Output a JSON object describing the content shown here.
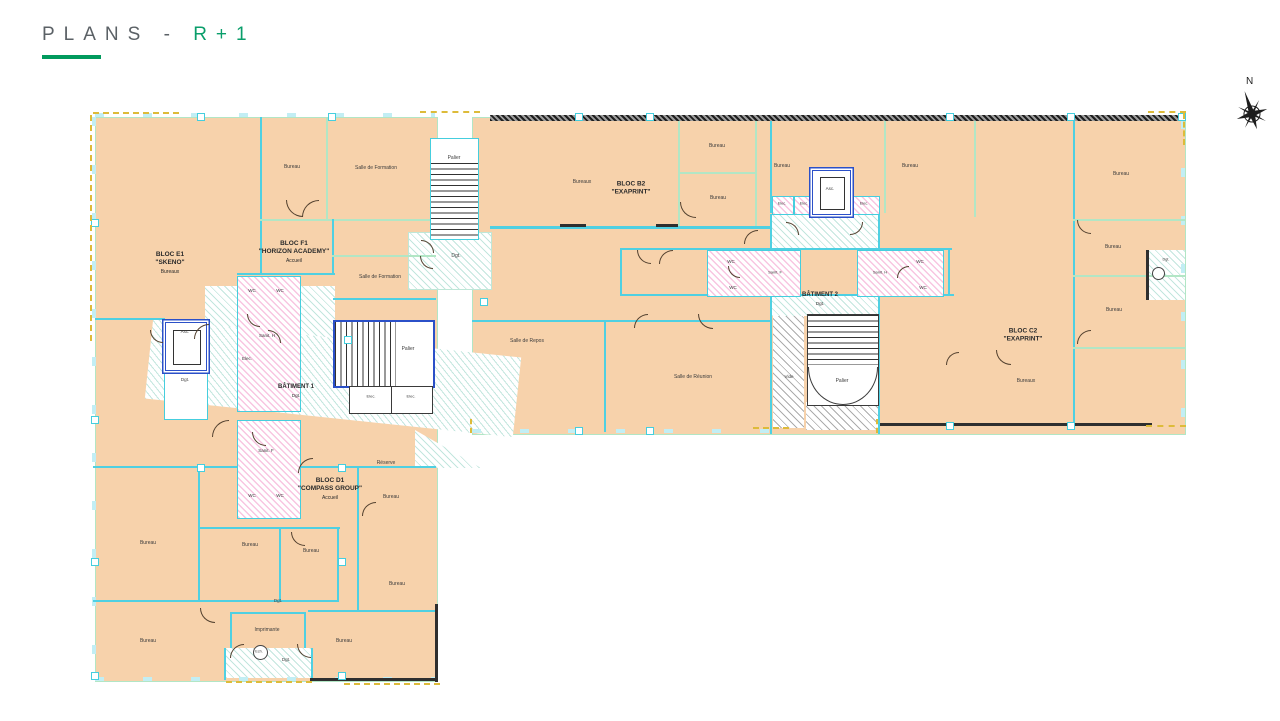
{
  "title": {
    "prefix": "PLANS -",
    "floor": "R+1"
  },
  "compass": {
    "north": "N"
  },
  "colors": {
    "accent_green": "#019a5d",
    "floor_text_green": "#0a9e6b",
    "room_fill": "#f7d2ab",
    "wall_cyan": "#4fd0e2",
    "wall_green": "#b2e6c5",
    "detail_blue": "#2b50c8",
    "sanitary_pink": "#f296c8",
    "accent_yellow": "#ddbb3a"
  },
  "blocks": {
    "e1": {
      "line1": "BLOC E1",
      "line2": "\"SKENO\"",
      "line3": "Bureaux"
    },
    "f1": {
      "line1": "BLOC F1",
      "line2": "\"HORIZON ACADEMY\"",
      "line3": "Accueil"
    },
    "b2": {
      "line1": "BLOC B2",
      "line2": "\"EXAPRINT\""
    },
    "c2": {
      "line1": "BLOC C2",
      "line2": "\"EXAPRINT\"",
      "line3": "Bureaux"
    },
    "d1": {
      "line1": "BLOC D1",
      "line2": "\"COMPASS GROUP\"",
      "line3": "Accueil"
    }
  },
  "buildings": {
    "b1": "BÂTIMENT 1",
    "b2": "BÂTIMENT 2"
  },
  "rooms": {
    "bureau": "Bureau",
    "bureaux": "Bureaux",
    "salle_formation": "Salle de Formation",
    "salle_repos": "Salle de Repos",
    "salle_reunion": "Salle de Réunion",
    "palier": "Palier",
    "dgt": "Dgt.",
    "wc": "WC",
    "sanit_f": "Sanit. F",
    "sanit_h": "Sanit. H",
    "elec": "Elec.",
    "asc": "Asc.",
    "imprimante": "Imprimante",
    "reserve": "Réserve",
    "vide": "Vide",
    "ech": "Ech."
  }
}
